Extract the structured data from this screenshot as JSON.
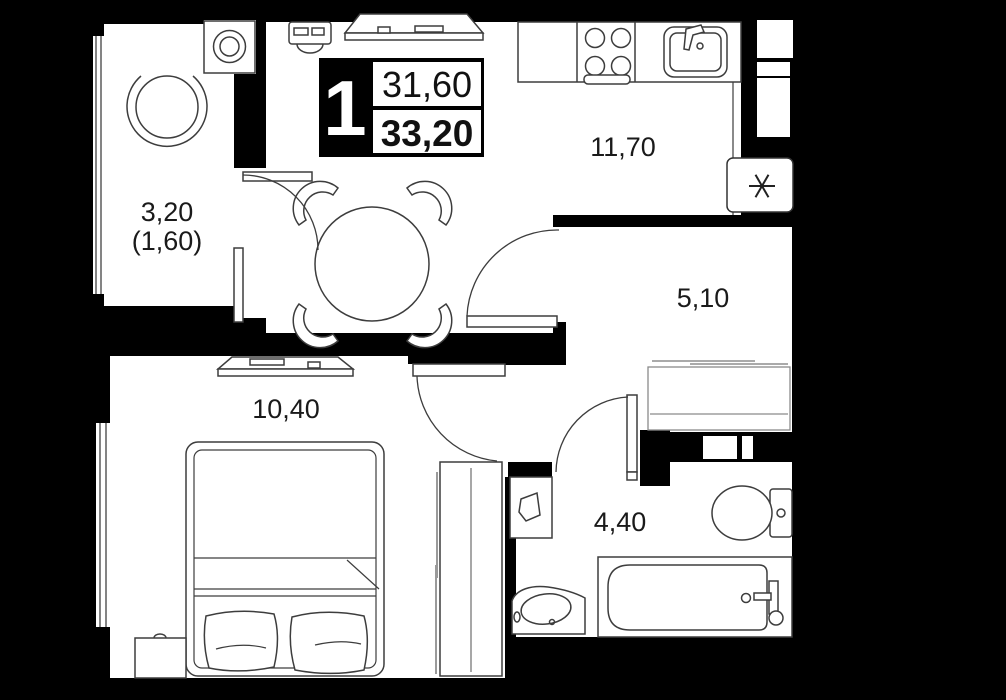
{
  "floor_plan": {
    "unit_badge": {
      "rooms_count": "1",
      "area_living": "31,60",
      "area_total": "33,20"
    },
    "room_labels": {
      "balcony_area": "3,20",
      "balcony_area_reduced": "(1,60)",
      "kitchen_living_area": "11,70",
      "hallway_area": "5,10",
      "bedroom_area": "10,40",
      "bathroom_area": "4,40"
    },
    "icons": {
      "ventilation_shaft_icon": "six-point-asterisk"
    },
    "colors": {
      "background": "#000000",
      "floor": "#ffffff",
      "furniture_outline": "#3d3d3d",
      "label_text": "#1a1a1a"
    }
  }
}
